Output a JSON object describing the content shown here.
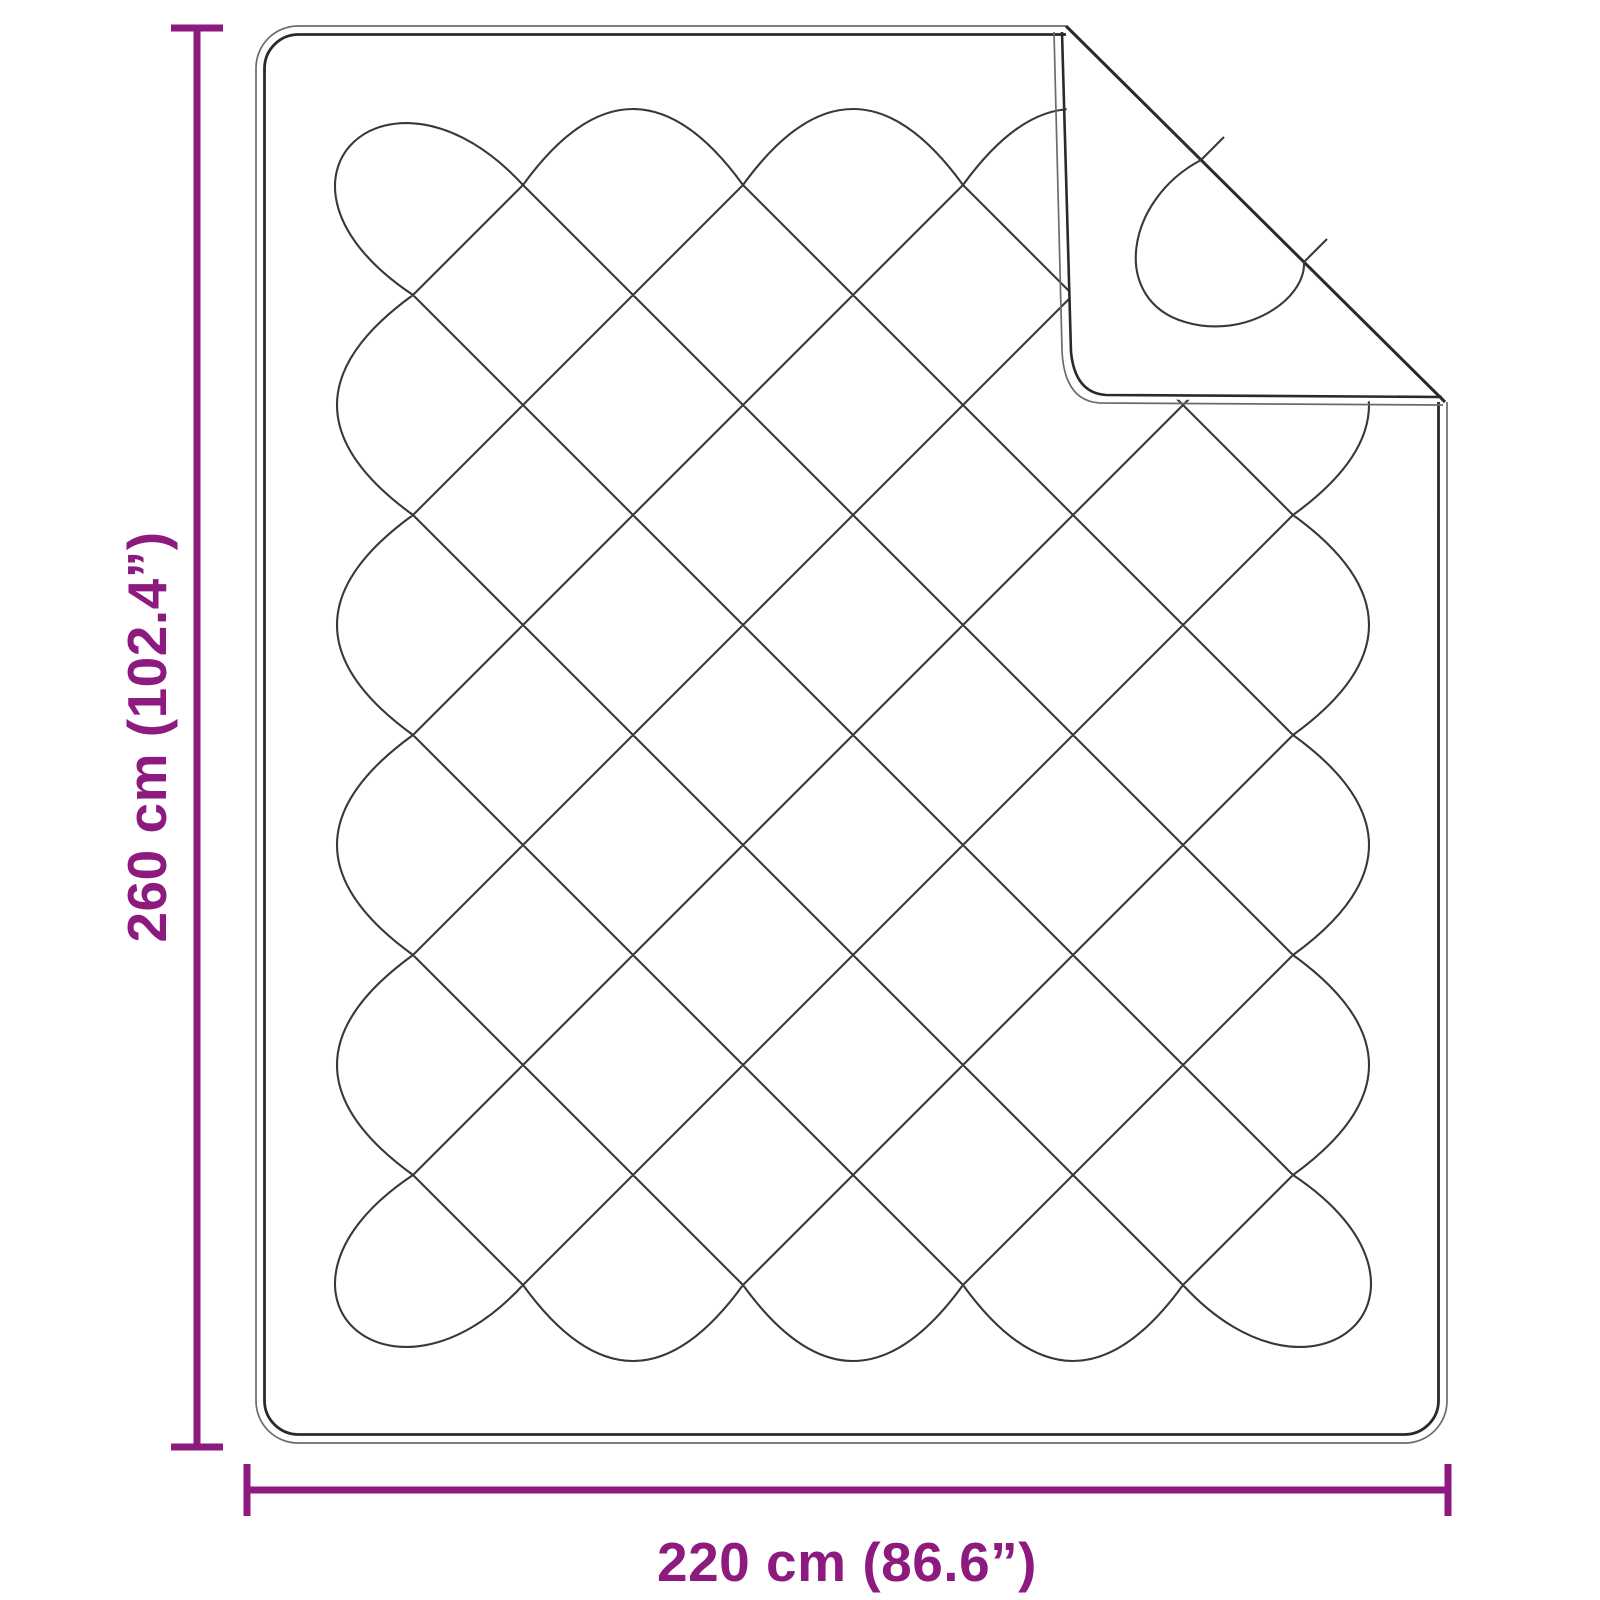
{
  "diagram": {
    "type": "product-dimension-diagram",
    "subject": "quilted-blanket-with-folded-corner",
    "height_label": "260 cm (102.4”)",
    "width_label": "220 cm (86.6”)"
  },
  "colors": {
    "accent": "#8C1A7F",
    "background": "#FFFFFF",
    "outline_dark": "#2A2A2A",
    "outline_light": "#6B6B6B",
    "quilt_line": "#383838"
  },
  "geometry": {
    "canvas": {
      "w": 1600,
      "h": 1600
    },
    "blanket": {
      "x": 256,
      "y": 26,
      "w": 1191,
      "h": 1417,
      "r_outer": 42,
      "inset": 8.5,
      "r_inner": 34
    },
    "lattice": {
      "x0": 413,
      "y0": 185,
      "step": 110,
      "cols": 8,
      "rows": 10,
      "petal_bulge": 152
    },
    "corner_petal": {
      "dx1": -133,
      "dy1": -145,
      "dx2": -173,
      "dy2": -5
    },
    "fold": {
      "ax": 1066,
      "ay": 26,
      "bx": 1445,
      "by": 402,
      "corner_x": 1072,
      "corner_y": 397
    },
    "fold_quilt": {
      "teardrop": "M1201,160 C1125,200 1110,300 1185,322 C1245,340 1306,300 1304,262",
      "tick1": "M1201,160 L1224,137",
      "tick2": "M1304,262 L1327,239"
    },
    "dims": {
      "v_x": 197,
      "v_y1": 28,
      "v_y2": 1447,
      "h_y": 1490,
      "h_x1": 247,
      "h_x2": 1448,
      "cap_half": 26,
      "stroke": 7
    }
  }
}
